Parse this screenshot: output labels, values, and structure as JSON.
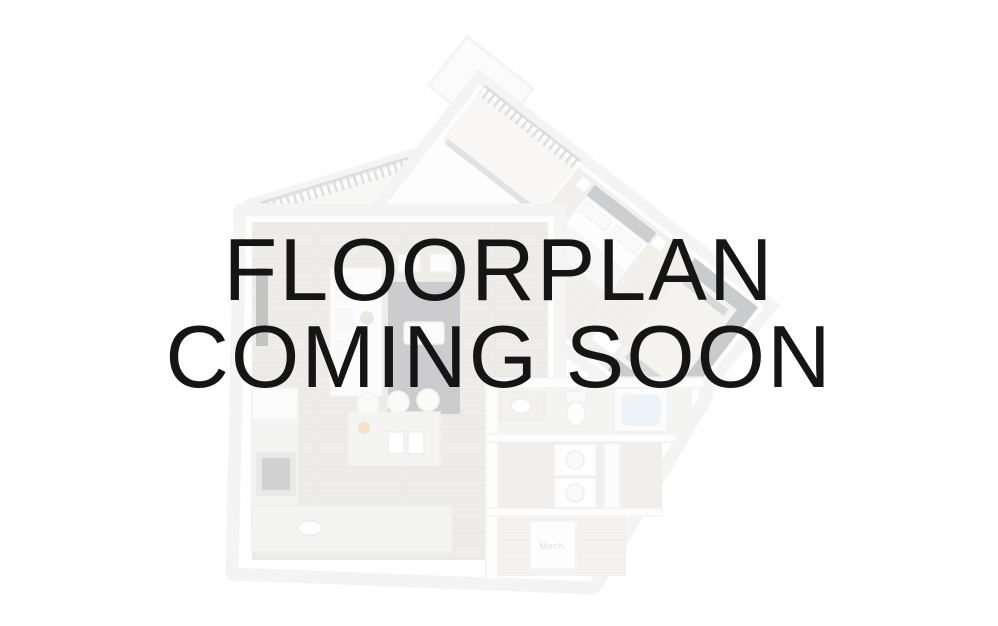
{
  "page": {
    "background_color": "#ffffff",
    "description_text_color": "#151515"
  },
  "headline": {
    "line1": "FLOORPLAN",
    "line2": "COMING SOON"
  },
  "illustration": {
    "mech_label": "Mech.",
    "opacity": "0.3",
    "colors": {
      "walls": "#e0e0e0",
      "wood_floor_living": "#c8c1b5",
      "wood_floor_bedroom": "#d7d0c6",
      "balcony_floor": "#e9e7e3",
      "rug": "#5a5a61",
      "granite_counter": "#dddbd6",
      "closet_shelves": "#50555c",
      "tub_water": "#c7d9e4",
      "plant": "#a8c39a",
      "stove": "#6b6b6b",
      "accent_flowers": "#e8a24a"
    }
  }
}
